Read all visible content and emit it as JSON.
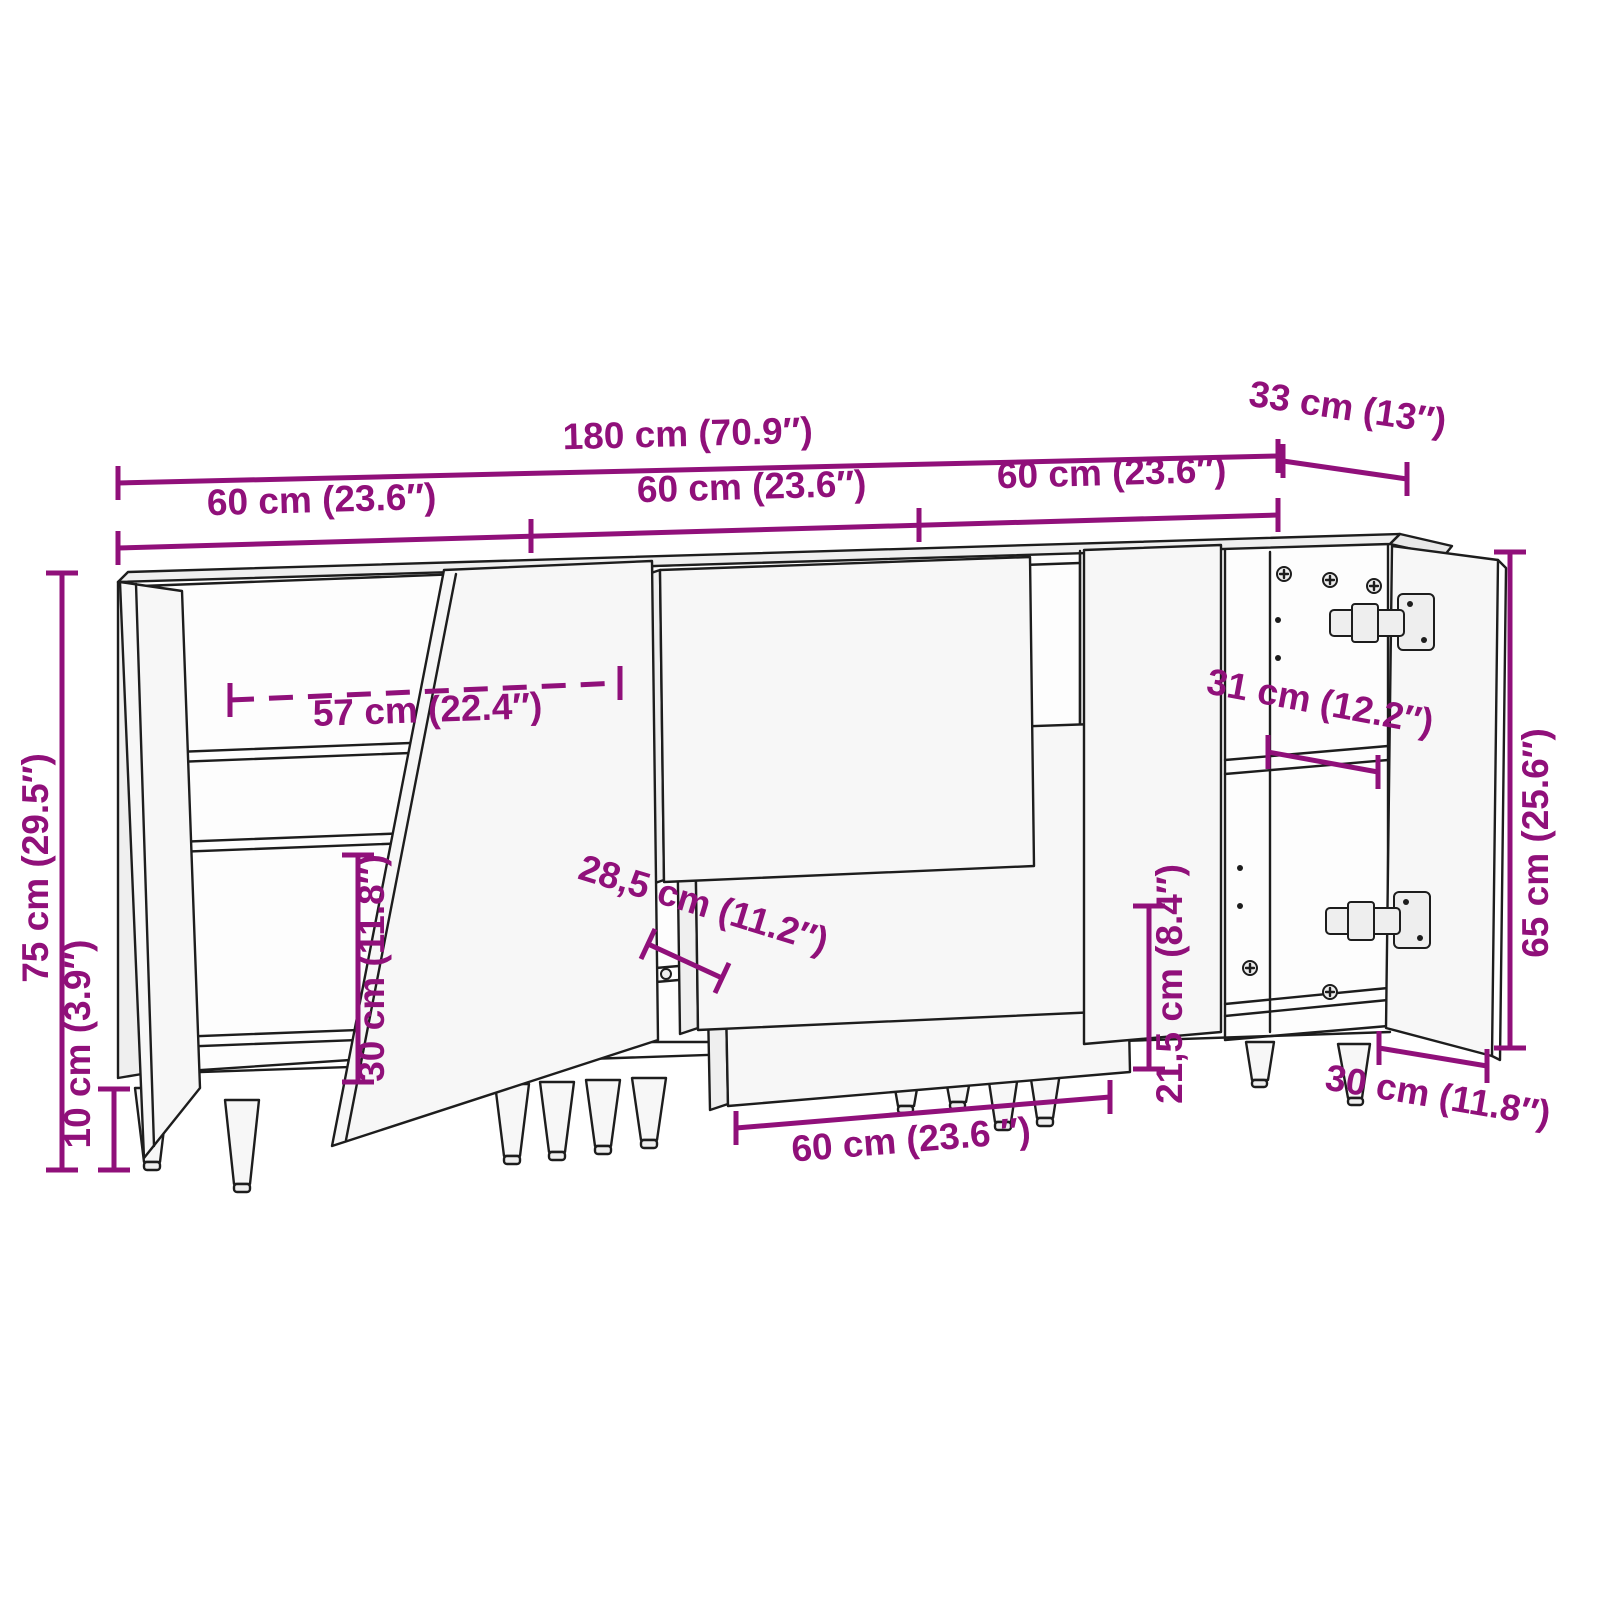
{
  "diagram": {
    "accent_color": "#90107a",
    "line_color": "#1d1d1d",
    "dimensions": {
      "total_width": "180 cm (70.9″)",
      "depth": "33 cm (13″)",
      "section_left_width": "60 cm (23.6″)",
      "section_middle_width": "60 cm (23.6″)",
      "section_right_width": "60 cm (23.6″)",
      "total_height": "75 cm (29.5″)",
      "leg_height": "10 cm (3.9″)",
      "interior_width": "57 cm (22.4″)",
      "left_compartment_height": "30 cm (11.8″)",
      "drawer_inner_depth": "28,5 cm (11.2″)",
      "drawer_width": "60 cm (23.6 ″)",
      "right_compartment_height": "21,5 cm (8.4″)",
      "shelf_depth": "31 cm (12.2″)",
      "body_height": "65 cm (25.6″)",
      "door_width": "30 cm (11.8″)"
    }
  }
}
